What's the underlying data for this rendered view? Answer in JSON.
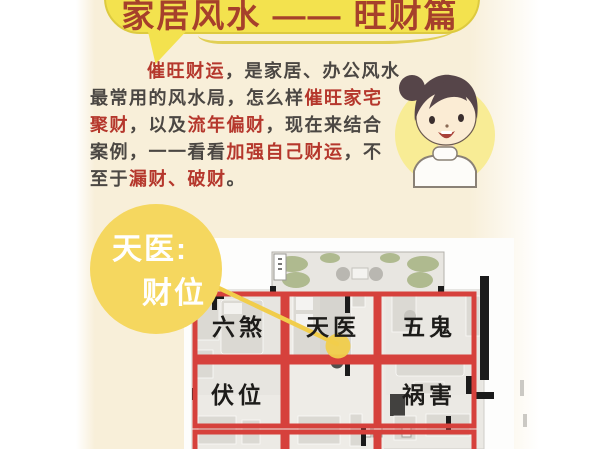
{
  "theme": {
    "card_bg": "#f8efd9",
    "bubble_yellow": "#f3e24e",
    "bubble_outline": "#ddca3f",
    "title_red": "#a6402b",
    "text_dark": "#4b4743",
    "text_red": "#b5372c",
    "callout_yellow": "#f5d75f",
    "callout_text": "#ffffff",
    "avatar_bg": "#f8ec95",
    "grid_red": "#d6413c",
    "marker_yellow": "#f1cd4b",
    "label_black": "#1d1c1a"
  },
  "title": {
    "text": "家居风水 —— 旺财篇"
  },
  "intro": {
    "line1": {
      "highlight": "催旺财运",
      "rest": "，是家居、办公风水"
    },
    "line2": {
      "start": "最常用的风水局，怎么样",
      "highlight": "催旺家宅"
    },
    "line3": {
      "h1": "聚财",
      "mid": "，以及",
      "h2": "流年偏财",
      "end": "，现在来结合"
    },
    "line4": {
      "start": "案例，一一看看",
      "highlight": "加强自己财运",
      "end": "，不"
    },
    "line5": {
      "start": "至于",
      "highlight": "漏财、破财",
      "end": "。"
    }
  },
  "callout": {
    "line1": "天医:",
    "line2": "财位"
  },
  "floor_plan": {
    "labels": {
      "top_left": "六煞",
      "top_center": "天医",
      "top_right": "五鬼",
      "mid_left": "伏位",
      "mid_right": "祸害"
    }
  }
}
